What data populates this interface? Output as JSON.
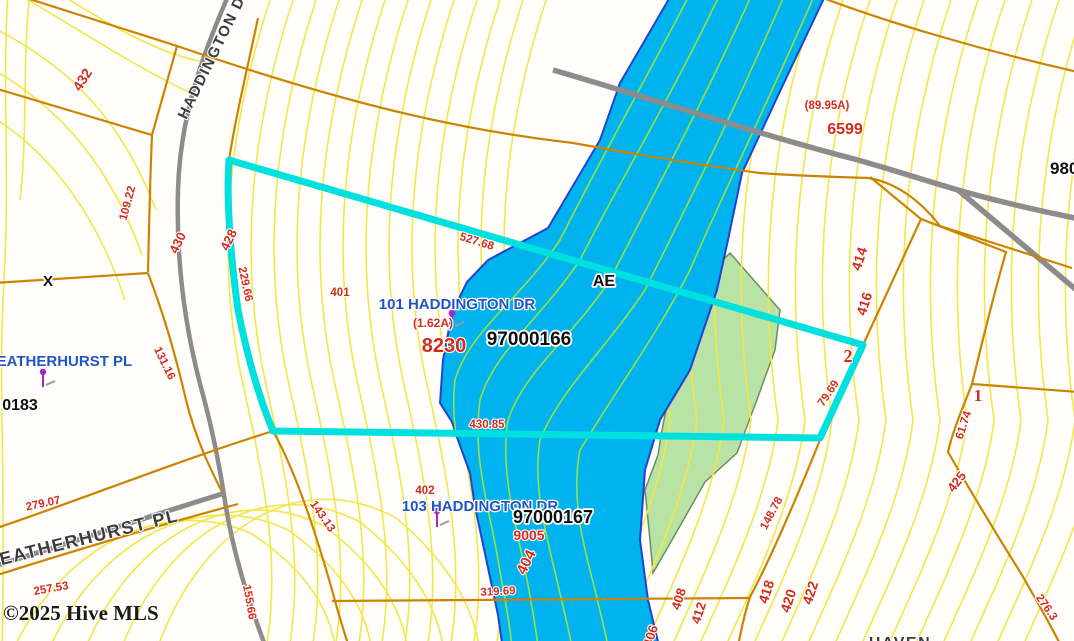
{
  "map_type": "parcel-gis-map",
  "watermark": "©2025 Hive MLS",
  "colors": {
    "water": "#00b2ee",
    "water_outline": "#2343cf",
    "flood_green_fill": "#b9e3a4",
    "flood_green_edge": "#6b8f5a",
    "parcel_highlight_cyan": "#00e0df",
    "contour_yellow": "#f2e747",
    "contour_water_green": "#97e23e",
    "parcel_line_orange": "#cc8400",
    "road_gray": "#8c8c8c",
    "label_red": "#d32b1c",
    "label_blue": "#2155c4",
    "pin_purple": "#a428c8"
  },
  "flood_zone": {
    "label": "AE"
  },
  "labels": {
    "n432": "432",
    "street_haddington": "HADDINGTON DR",
    "d109_22": "109.22",
    "n430": "430",
    "n428": "428",
    "d229_66": "229.66",
    "x_marker": "X",
    "d131_16": "131.16",
    "street_heatherhurst_blue": "HEATHERHURST PL",
    "pin_0183": "0183",
    "d279_07": "279.07",
    "street_heatherhurst_road": "HEATHERHURST PL",
    "d257_53": "257.53",
    "watermark": "©2025 Hive MLS",
    "d155_66": "155.66",
    "d143_13": "143.13",
    "n401": "401",
    "addr_101": "101 HADDINGTON DR",
    "area_1_62": "(1.62A)",
    "n8230": "8230",
    "pin_97000166": "97000166",
    "d527_68": "527.68",
    "flood_ae": "AE",
    "d430_85": "430.85",
    "area_89_95": "(89.95A)",
    "n6599": "6599",
    "pin_980": "980",
    "n414": "414",
    "n416": "416",
    "n2": "2",
    "d79_69": "79.69",
    "n1": "1",
    "d61_74": "61.74",
    "n425": "425",
    "d276_3": "276.3",
    "d148_78": "148.78",
    "n418": "418",
    "n420": "420",
    "n422": "422",
    "n412": "412",
    "n408": "408",
    "n406": "406",
    "n402": "402",
    "addr_103": "103 HADDINGTON DR",
    "pin_97000167": "97000167",
    "n9005": "9005",
    "n404": "404",
    "d319_69": "319.69",
    "street_haven_partial": "HAVEN"
  },
  "parcels": [
    {
      "address": "101 HADDINGTON DR",
      "parcel_id": "97000166",
      "area": "(1.62A)",
      "number": "8230"
    },
    {
      "address": "103 HADDINGTON DR",
      "parcel_id": "97000167",
      "number": "9005"
    },
    {
      "parcel_id_partial": "0183"
    },
    {
      "parcel_id_partial": "980"
    },
    {
      "number": "6599",
      "area": "(89.95A)"
    }
  ]
}
